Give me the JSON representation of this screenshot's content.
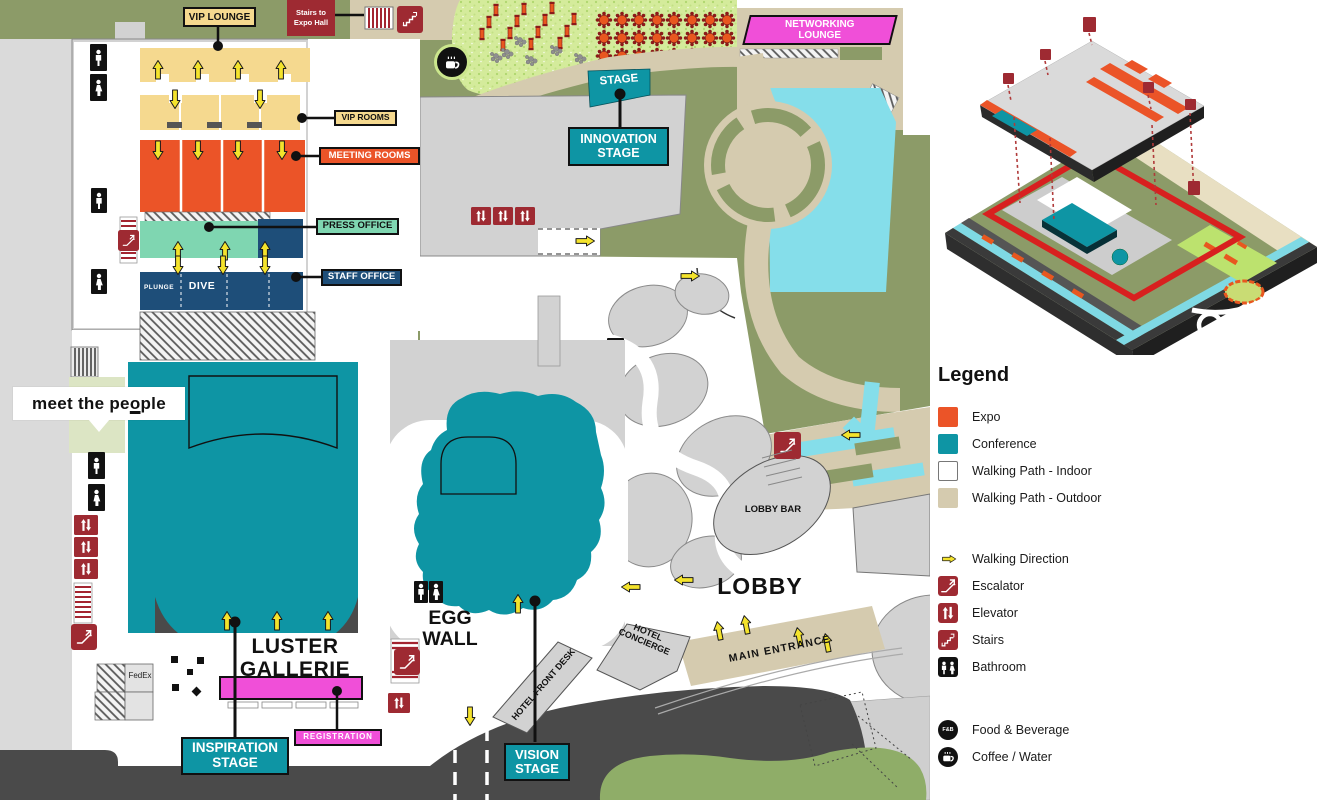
{
  "map": {
    "labels": {
      "vip_lounge": "VIP LOUNGE",
      "stairs_expo": "Stairs to Expo Hall",
      "vip_rooms": "VIP ROOMS",
      "meeting_rooms": "MEETING ROOMS",
      "press_office": "PRESS OFFICE",
      "staff_office": "STAFF OFFICE",
      "plunge": "PLUNGE",
      "dive": "DIVE",
      "luster_gallerie": "LUSTER\nGALLERIE",
      "registration": "REGISTRATION",
      "inspiration_stage": "INSPIRATION\nSTAGE",
      "fedex": "FedEx",
      "egg_wall": "EGG\nWALL",
      "vision_stage": "VISION\nSTAGE",
      "hotel_front_desk": "HOTEL FRONT DESK",
      "hotel_concierge": "HOTEL\nCONCIERGE",
      "main_entrance": "MAIN ENTRANCE",
      "lobby": "LOBBY",
      "lobby_bar": "LOBBY BAR",
      "stage": "STAGE",
      "innovation_stage": "INNOVATION\nSTAGE",
      "networking_lounge": "NETWORKING\nLOUNGE"
    },
    "brand": {
      "pre": "meet the pe",
      "o": "o",
      "post": "ple"
    }
  },
  "legend": {
    "title": "Legend",
    "areas": [
      {
        "label": "Expo",
        "color": "#EB5428"
      },
      {
        "label": "Conference",
        "color": "#0E95A4"
      },
      {
        "label": "Walking Path - Indoor",
        "color": "#FFFFFF"
      },
      {
        "label": "Walking Path - Outdoor",
        "color": "#D5CBAF"
      }
    ],
    "icons": [
      {
        "label": "Walking Direction",
        "icon": "walking-direction-arrow",
        "color": "#F4E32C"
      },
      {
        "label": "Escalator",
        "icon": "escalator-icon",
        "color": "#9E2A32"
      },
      {
        "label": "Elevator",
        "icon": "elevator-icon",
        "color": "#9E2A32"
      },
      {
        "label": "Stairs",
        "icon": "stairs-icon",
        "color": "#9E2A32"
      },
      {
        "label": "Bathroom",
        "icon": "bathroom-icon",
        "color": "#111111"
      }
    ],
    "services": [
      {
        "label": "Food & Beverage",
        "badge": "F&B"
      },
      {
        "label": "Coffee / Water"
      }
    ]
  }
}
